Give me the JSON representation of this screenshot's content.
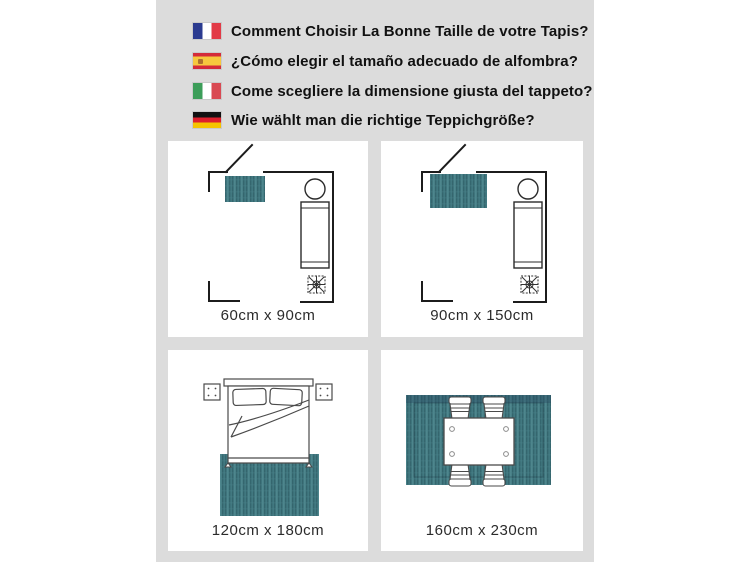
{
  "header": {
    "questions": [
      {
        "language": "French",
        "flag_icon": "france-flag-icon",
        "text": "Comment Choisir La Bonne Taille de votre Tapis?"
      },
      {
        "language": "Spanish",
        "flag_icon": "spain-flag-icon",
        "text": "¿Cómo elegir el tamaño adecuado de alfombra?"
      },
      {
        "language": "Italian",
        "flag_icon": "italy-flag-icon",
        "text": "Come scegliere la dimensione giusta del tappeto?"
      },
      {
        "language": "German",
        "flag_icon": "germany-flag-icon",
        "text": "Wie wählt man die richtige Teppichgröße?"
      }
    ]
  },
  "cards": [
    {
      "size_label": "60cm x 90cm",
      "scene": "bedroom-floor-plan-small-rug"
    },
    {
      "size_label": "90cm x 150cm",
      "scene": "bedroom-floor-plan-medium-rug"
    },
    {
      "size_label": "120cm x 180cm",
      "scene": "double-bed-top-view-rug"
    },
    {
      "size_label": "160cm x 230cm",
      "scene": "dining-table-four-chairs-rug"
    }
  ],
  "colors": {
    "page_background": "#ffffff",
    "panel_background": "#dcdcdc",
    "card_background": "#ffffff",
    "rug_teal": "#417880",
    "rug_teal_dark": "#2c5a62",
    "rug_teal_light": "#578f96",
    "line_black": "#1c1c1c",
    "label_text": "#2b2b2b"
  }
}
